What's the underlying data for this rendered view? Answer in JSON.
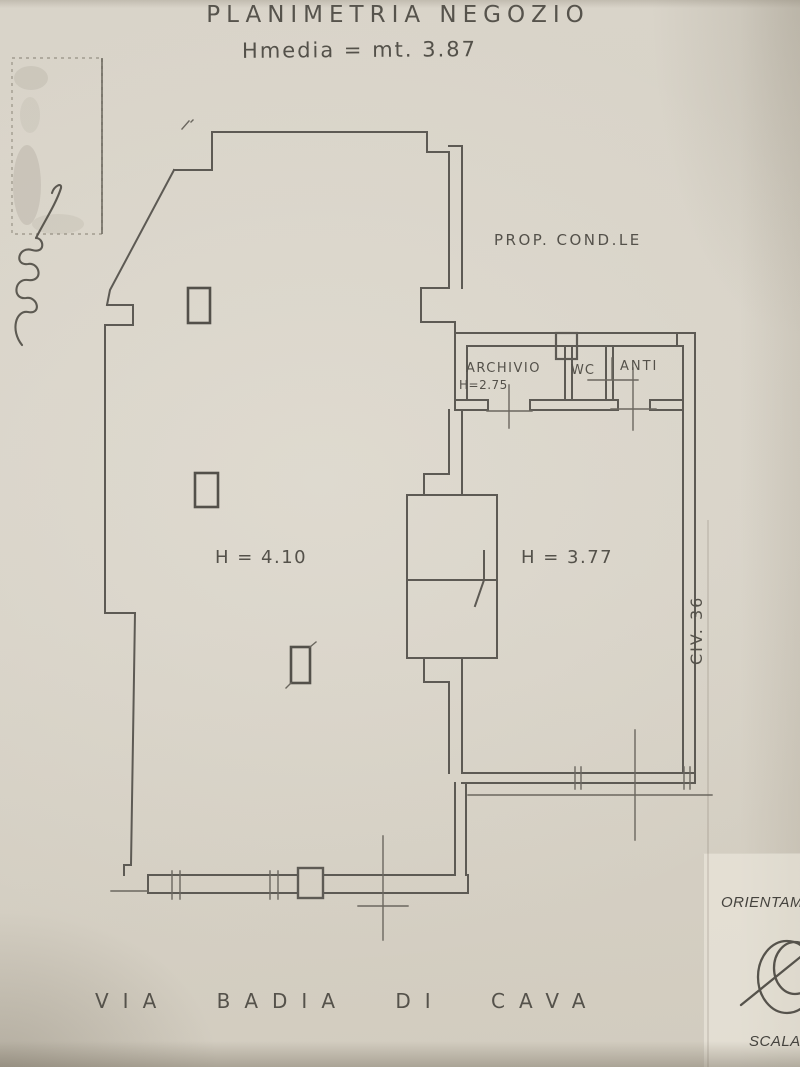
{
  "title": "PLANIMETRIA NEGOZIO",
  "subtitle": "Hmedia = mt. 3.87",
  "plan_labels": {
    "prop_condle": "PROP. COND.LE",
    "archivio": "ARCHIVIO",
    "archivio_height": "H=2.75",
    "wc": "WC",
    "anti": "ANTI",
    "height_main_room": "H = 4.10",
    "height_right_room": "H = 3.77",
    "civic_number": "CIV. 36"
  },
  "margin_notes": {
    "left_vertical_note": "DEPOSITATO PRESSO L'U.T.E.",
    "street_name": "VIA BADIA DI CAVA"
  },
  "form_labels": {
    "orientation": "ORIENTAM",
    "scale": "SCALA"
  },
  "icons": {
    "compass": "compass-icon",
    "signature": "signature-scribble",
    "stamp": "stamp-mark"
  },
  "colors": {
    "paper": "#d7d2c7",
    "ink": "#5d5a54",
    "handwriting": "#54514a"
  }
}
